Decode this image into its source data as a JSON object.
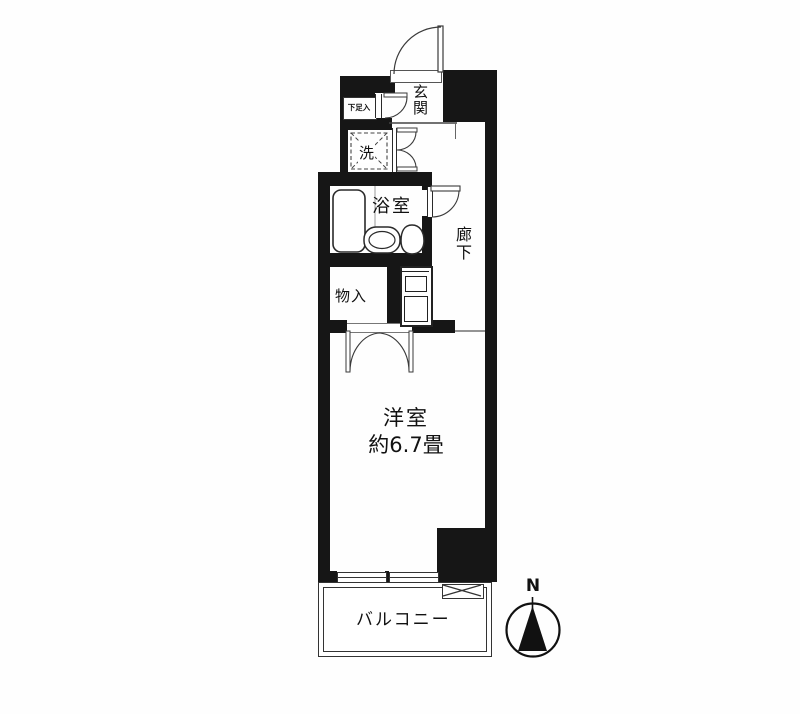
{
  "plan_title": "apartment-floor-plan",
  "rooms": {
    "genkan": "玄関",
    "shoe_box": "下足入",
    "washer": "洗",
    "bathroom": "浴室",
    "hallway": "廊下",
    "storage": "物入",
    "main_room": "洋室",
    "main_room_size": "約6.7畳",
    "balcony": "バルコニー"
  },
  "compass": {
    "north": "N"
  },
  "colors": {
    "wall": "#161616",
    "line": "#3a3a3a",
    "background": "#ffffff"
  }
}
